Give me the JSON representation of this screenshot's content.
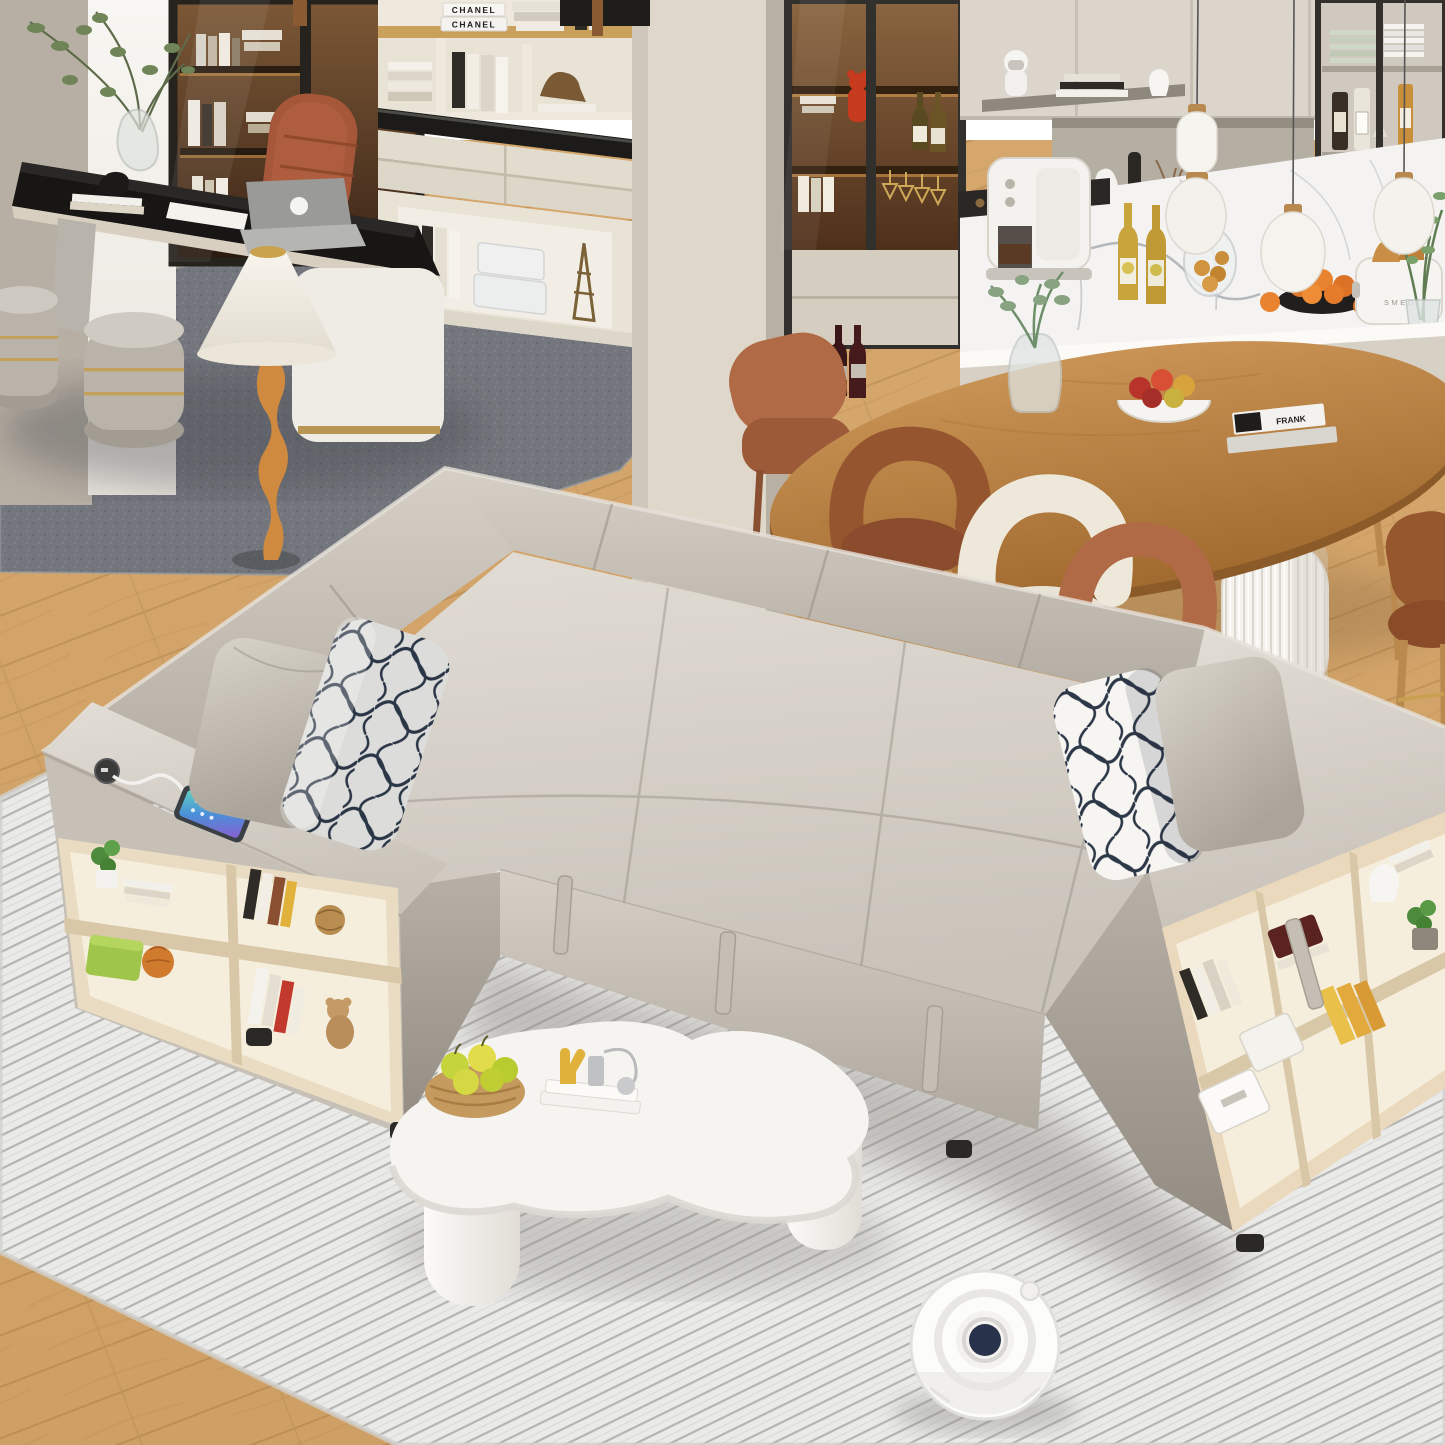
{
  "scene": {
    "description": "3D render of an open-plan living room: beige U-shaped storage sleeper sectional with pulled-out bed, bookshelf storage arms and USB charging station with phone, patterned navy-and-white pillows, white cloud-shaped coffee table with apple basket, white robot vacuum on a ribbed light-gray rug; behind are a black home-office desk with laptop and brown chair, cream shelving, lit display cabinets, an oval wood dining table with terracotta and cream chairs, and a white kitchen with marble backsplash",
    "texts": {
      "book_spine_top": "CHANEL",
      "book_spine_bottom": "CHANEL",
      "toaster_brand": "SMEG",
      "table_book_title": "FRANK"
    },
    "palette": {
      "wood_floor": "#d2a368",
      "area_rug": "#e7e7e5",
      "office_rug": "#73767c",
      "wall_beige": "#b7afa3",
      "wall_cream": "#ded7ca",
      "sofa_fabric_light": "#d9d4cc",
      "sofa_fabric_mid": "#c5bfb5",
      "sofa_fabric_dark": "#a59e93",
      "pillow_pattern_navy": "#2c3747",
      "shelf_wood": "#e9dcc2",
      "cabinet_interior_brown": "#6e4a2e",
      "dining_table_wood": "#b9834a",
      "chair_terracotta": "#b06a45",
      "chair_cream": "#ece6d8",
      "coffee_table_white": "#f6f4f0",
      "apple_green": "#c6d43c",
      "robot_center_navy": "#28324a",
      "desk_black": "#171614"
    },
    "objects": [
      {
        "name": "sectional-sofa-bed",
        "label": "beige U-shaped sleeper sectional with pull-out bed"
      },
      {
        "name": "sofa-arm-bookshelf-left",
        "label": "left storage arm with shelves, USB port and phone"
      },
      {
        "name": "sofa-arm-bookshelf-right",
        "label": "right storage arm with bookshelf"
      },
      {
        "name": "patterned-pillows",
        "label": "navy-and-white patterned throw pillows"
      },
      {
        "name": "coffee-table",
        "label": "white cloud-shaped coffee table with apples"
      },
      {
        "name": "robot-vacuum",
        "label": "white robot vacuum"
      },
      {
        "name": "office-desk",
        "label": "black desk with laptop and brown chair"
      },
      {
        "name": "floor-lamp",
        "label": "white cone floor lamp with twisted wood stand"
      },
      {
        "name": "dining-table",
        "label": "oval wood dining table with fruit bowl and books"
      },
      {
        "name": "kitchen",
        "label": "white kitchen with marble backsplash, coffee maker and toaster"
      }
    ]
  }
}
